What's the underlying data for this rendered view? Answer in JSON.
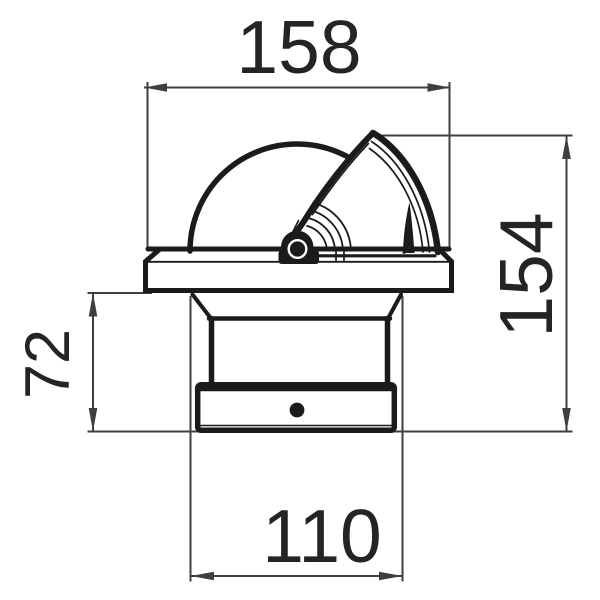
{
  "drawing": {
    "type": "dimensioned technical line drawing",
    "subject": "flush-mount marine compass, side elevation",
    "dimensions": {
      "top_width": "158",
      "right_height": "154",
      "left_height": "72",
      "bottom_width": "110"
    },
    "colors": {
      "background": "#ffffff",
      "object_line": "#1b1b1b",
      "dimension_line": "#3f3f3f",
      "text": "#242424"
    }
  }
}
